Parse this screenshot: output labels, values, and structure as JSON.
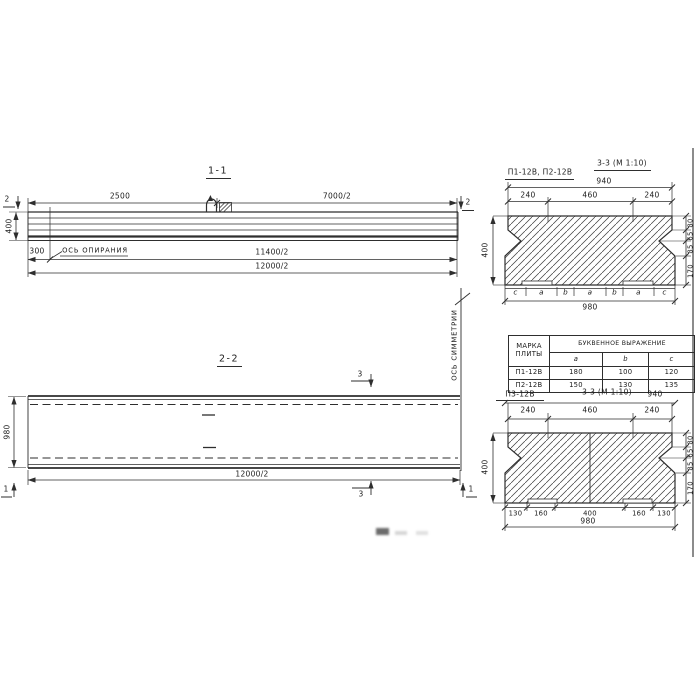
{
  "colors": {
    "ink": "#2e2e2e",
    "paper": "#ffffff"
  },
  "section11": {
    "title": "1-1",
    "dim_2500": "2500",
    "dim_7000": "7000/2",
    "dim_400": "400",
    "dim_300": "300",
    "support_axis": "ОСЬ ОПИРАНИЯ",
    "dim_11400": "11400/2",
    "dim_12000": "12000/2",
    "cut2": "2"
  },
  "section22": {
    "title": "2-2",
    "dim_980": "980",
    "dim_12000": "12000/2",
    "cut3": "3",
    "cut1": "1",
    "symmetry_axis": "ОСЬ СИММЕТРИИ"
  },
  "section33top": {
    "title": "3-3 (М 1:10)",
    "marks": "П1-12В, П2-12В",
    "dim_940": "940",
    "dims_top": [
      "240",
      "460",
      "240"
    ],
    "dim_left": "400",
    "dims_right": [
      "80",
      "65",
      "85",
      "170"
    ],
    "letters": [
      "c",
      "a",
      "b",
      "a",
      "b",
      "a",
      "c"
    ],
    "dim_980": "980"
  },
  "table": {
    "header_mark": "МАРКА ПЛИТЫ",
    "header_expr": "БУКВЕННОЕ ВЫРАЖЕНИЕ",
    "cols": [
      "a",
      "b",
      "c"
    ],
    "rows": [
      {
        "mark": "П1-12В",
        "a": "180",
        "b": "100",
        "c": "120"
      },
      {
        "mark": "П2-12В",
        "a": "150",
        "b": "130",
        "c": "135"
      }
    ]
  },
  "section33bottom": {
    "mark": "П3-12В",
    "title": "3-3 (М 1:10)",
    "dim_940": "940",
    "dims_top": [
      "240",
      "460",
      "240"
    ],
    "dim_left": "400",
    "dims_right": [
      "80",
      "65",
      "85",
      "170"
    ],
    "dims_bottom": [
      "130",
      "160",
      "400",
      "160",
      "130"
    ],
    "dim_980": "980"
  }
}
